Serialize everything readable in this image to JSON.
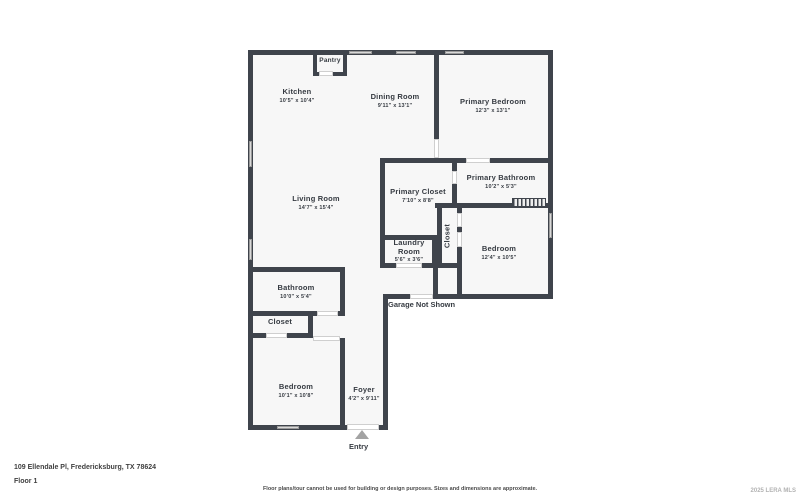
{
  "plan": {
    "rooms": [
      {
        "name": "Pantry",
        "dims": ""
      },
      {
        "name": "Kitchen",
        "dims": "10'5\" x 10'4\""
      },
      {
        "name": "Dining Room",
        "dims": "9'11\" x 13'1\""
      },
      {
        "name": "Primary Bedroom",
        "dims": "12'3\" x 13'1\""
      },
      {
        "name": "Living Room",
        "dims": "14'7\" x 15'4\""
      },
      {
        "name": "Primary Closet",
        "dims": "7'10\" x 8'8\""
      },
      {
        "name": "Primary Bathroom",
        "dims": "10'2\" x 5'3\""
      },
      {
        "name": "Laundry Room",
        "dims": "5'6\" x 3'6\""
      },
      {
        "name": "Closet",
        "dims": ""
      },
      {
        "name": "Bedroom",
        "dims": "12'4\" x 10'5\""
      },
      {
        "name": "Bathroom",
        "dims": "10'0\" x 5'4\""
      },
      {
        "name": "Closet",
        "dims": ""
      },
      {
        "name": "Bedroom",
        "dims": "10'1\" x 10'8\""
      },
      {
        "name": "Foyer",
        "dims": "4'2\" x 9'11\""
      }
    ],
    "annotations": {
      "garage_not_shown": "Garage Not Shown",
      "entry": "Entry"
    }
  },
  "footer": {
    "address": "109 Ellendale Pl, Fredericksburg, TX 78624",
    "floor": "Floor 1",
    "disclaimer": "Floor plans/tour cannot be used for building or design purposes. Sizes and dimensions are approximate.",
    "watermark": "2025 LERA MLS"
  },
  "colors": {
    "wall": "#3f444c",
    "floor": "#f7f7f7",
    "window": "#d9d9d9"
  }
}
